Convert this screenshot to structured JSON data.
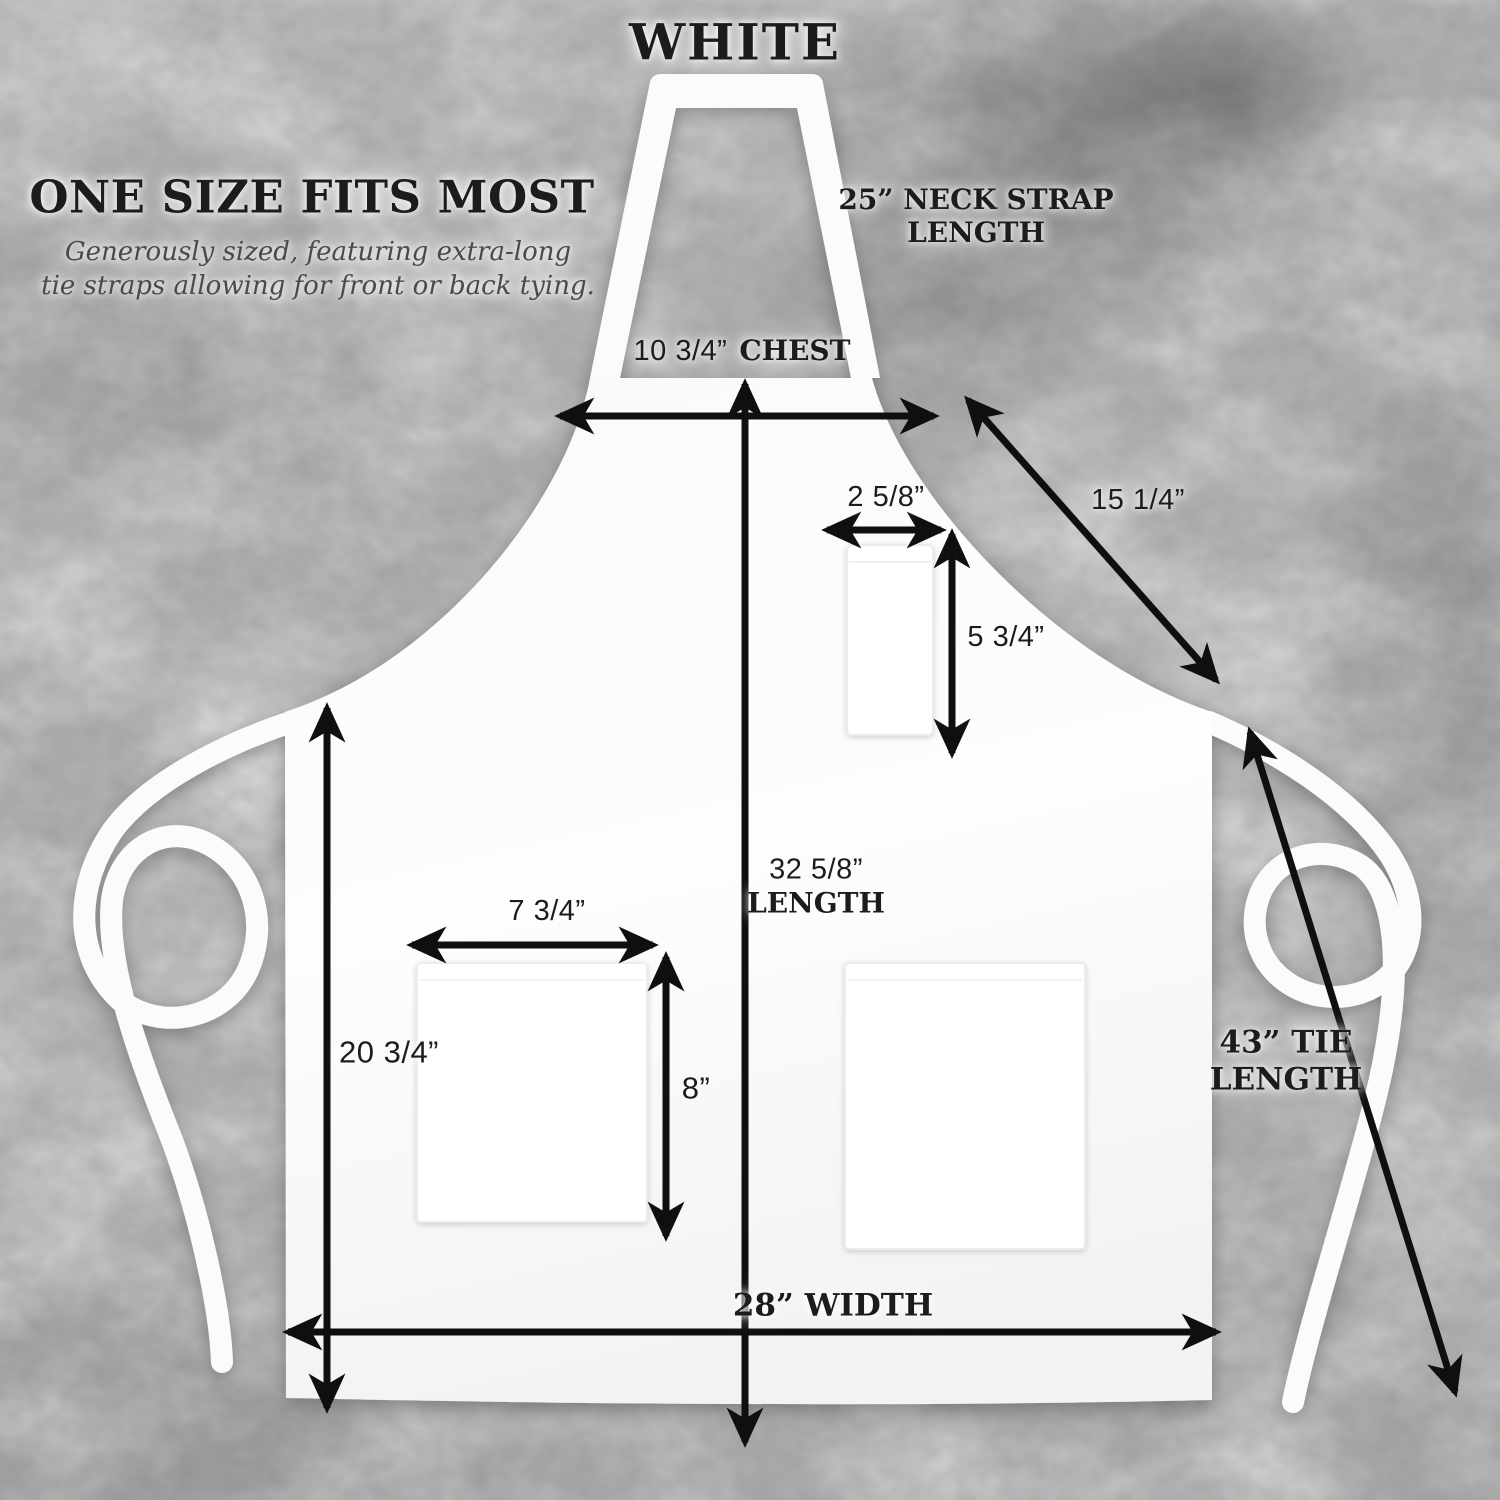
{
  "title": "WHITE",
  "intro": {
    "heading": "ONE SIZE FITS MOST",
    "subtitle": "Generously sized, featuring extra-long\ntie straps allowing for front or back tying."
  },
  "measurements": {
    "neck_strap": "25” NECK STRAP\nLENGTH",
    "chest_value": "10 3/4”",
    "chest_label": "CHEST",
    "neck_strap_diagonal": "15 1/4”",
    "chest_pocket_width": "2 5/8”",
    "chest_pocket_height": "5 3/4”",
    "length_value": "32 5/8”",
    "length_label": "LENGTH",
    "waist_pocket_width": "7 3/4”",
    "waist_pocket_height": "8”",
    "side_length": "20 3/4”",
    "width": "28” WIDTH",
    "tie_length": "43” TIE\nLENGTH"
  },
  "colors": {
    "background": "#d4d4d4",
    "apron": "#fdfdfd",
    "arrow": "#0f0f0f",
    "text": "#1c1c1c"
  }
}
